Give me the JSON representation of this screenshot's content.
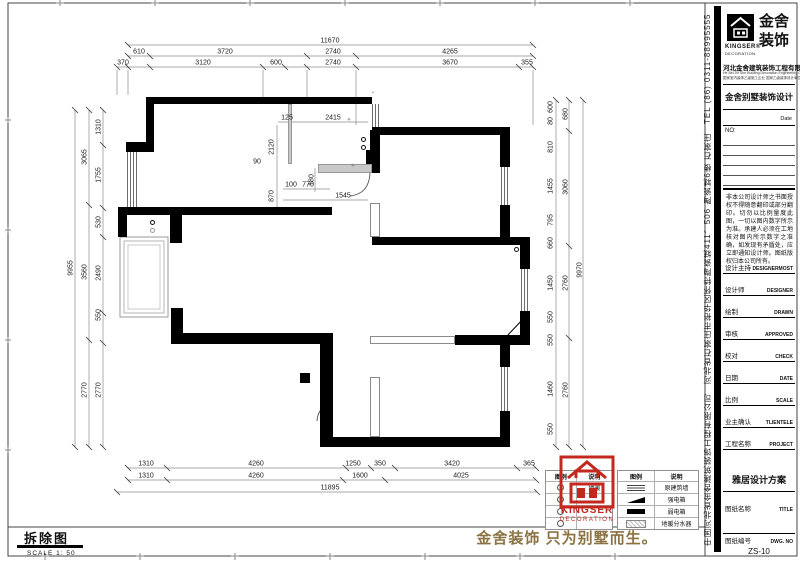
{
  "sheet": {
    "demolition_title": "拆除图",
    "scale_label": "SCALE 1: 50",
    "slogan": "金舍装饰 只为别墅而生。"
  },
  "title_block": {
    "side_text": "中国河北省金舍建筑装饰工程有限公司　河北省石家庄市裕华区怀特陶瓷城411、506 陶瓷城6楼 石家庄　TEL (86) 0311-88995555",
    "logo": {
      "brand_cn_1": "金舍",
      "brand_cn_2": "装饰",
      "brand_en": "KINGSER®",
      "brand_sub": "DECORATION"
    },
    "company": "河北金舍建筑装饰工程有限公司",
    "company_en": "He Bei Jin She Building Decoration Engineering Co.,Ltd",
    "company_note": "国家室内装饰乙级施工企业 国家乙级装饰设计单位",
    "project_type": "金舍别墅装饰设计",
    "date_label": "Date",
    "no_label": "NO:",
    "disclaimer": "非本公司设计师之书面授权不得随意翻印或部分翻印。切勿以比例量度此图，一切以图内数字所示为准。承建人必须在工地核对图内所示数字之准确，如发现有矛盾处，应立即通知设计师。图纸版权归本公司所有。",
    "rows": [
      {
        "cn": "设计主持",
        "en": "DESIGNERMOST"
      },
      {
        "cn": "设计师",
        "en": "DESIGNER"
      },
      {
        "cn": "绘制",
        "en": "DRAWN"
      },
      {
        "cn": "审核",
        "en": "APPROVED"
      },
      {
        "cn": "校对",
        "en": "CHECK"
      },
      {
        "cn": "日期",
        "en": "DATE"
      },
      {
        "cn": "比例",
        "en": "SCALE"
      },
      {
        "cn": "业主确认",
        "en": "TLIENTELE"
      },
      {
        "cn": "工程名称",
        "en": "PROJECT"
      }
    ],
    "project_name": "雅居设计方案",
    "title_row": {
      "cn": "图纸名称",
      "en": "TITLE"
    },
    "dwg_row": {
      "cn": "图纸编号",
      "en": "DWG. NO"
    },
    "dwg_no": "ZS-10"
  },
  "legend_left": {
    "headers": [
      "图例",
      "说明"
    ],
    "rows": [
      {
        "label": "地暖"
      },
      {
        "label": ""
      },
      {
        "label": ""
      },
      {
        "label": ""
      }
    ]
  },
  "legend_right": {
    "headers": [
      "图例",
      "说明"
    ],
    "rows": [
      {
        "label": "原建筑墙"
      },
      {
        "label": "强电箱"
      },
      {
        "label": "弱电箱"
      },
      {
        "label": "地暖分水器"
      }
    ]
  },
  "stamp": {
    "brand": "KINGSER",
    "sub": "DECORATION"
  },
  "colors": {
    "accent_red": "#c3281e",
    "slogan_gold": "#8a7243",
    "wall_black": "#000000"
  },
  "plan": {
    "labels": [
      {
        "t": "11670",
        "x": 330,
        "y": 41
      },
      {
        "t": "610",
        "x": 139,
        "y": 52
      },
      {
        "t": "3720",
        "x": 225,
        "y": 52
      },
      {
        "t": "2740",
        "x": 333,
        "y": 52
      },
      {
        "t": "4265",
        "x": 450,
        "y": 52
      },
      {
        "t": "370",
        "x": 123,
        "y": 63
      },
      {
        "t": "3120",
        "x": 203,
        "y": 63
      },
      {
        "t": "600",
        "x": 276,
        "y": 63
      },
      {
        "t": "2740",
        "x": 333,
        "y": 63
      },
      {
        "t": "3670",
        "x": 450,
        "y": 63
      },
      {
        "t": "355",
        "x": 527,
        "y": 63
      },
      {
        "t": "9955",
        "x": 71,
        "y": 268,
        "v": 1
      },
      {
        "t": "3065",
        "x": 85,
        "y": 157,
        "v": 1
      },
      {
        "t": "3560",
        "x": 85,
        "y": 272,
        "v": 1
      },
      {
        "t": "2770",
        "x": 85,
        "y": 390,
        "v": 1
      },
      {
        "t": "1310",
        "x": 99,
        "y": 127,
        "v": 1
      },
      {
        "t": "1755",
        "x": 99,
        "y": 175,
        "v": 1
      },
      {
        "t": "530",
        "x": 99,
        "y": 222,
        "v": 1
      },
      {
        "t": "2490",
        "x": 99,
        "y": 273,
        "v": 1
      },
      {
        "t": "550",
        "x": 99,
        "y": 315,
        "v": 1
      },
      {
        "t": "2770",
        "x": 99,
        "y": 390,
        "v": 1
      },
      {
        "t": "9970",
        "x": 580,
        "y": 270,
        "v": 1
      },
      {
        "t": "680",
        "x": 566,
        "y": 114,
        "v": 1
      },
      {
        "t": "3060",
        "x": 566,
        "y": 187,
        "v": 1
      },
      {
        "t": "2760",
        "x": 566,
        "y": 283,
        "v": 1
      },
      {
        "t": "2760",
        "x": 566,
        "y": 390,
        "v": 1
      },
      {
        "t": "600",
        "x": 551,
        "y": 107,
        "v": 1
      },
      {
        "t": "80",
        "x": 551,
        "y": 121,
        "v": 1
      },
      {
        "t": "810",
        "x": 551,
        "y": 147,
        "v": 1
      },
      {
        "t": "1455",
        "x": 551,
        "y": 186,
        "v": 1
      },
      {
        "t": "795",
        "x": 551,
        "y": 220,
        "v": 1
      },
      {
        "t": "660",
        "x": 551,
        "y": 243,
        "v": 1
      },
      {
        "t": "1450",
        "x": 551,
        "y": 283,
        "v": 1
      },
      {
        "t": "550",
        "x": 551,
        "y": 317,
        "v": 1
      },
      {
        "t": "550",
        "x": 551,
        "y": 340,
        "v": 1
      },
      {
        "t": "1460",
        "x": 551,
        "y": 389,
        "v": 1
      },
      {
        "t": "550",
        "x": 551,
        "y": 429,
        "v": 1
      },
      {
        "t": "1310",
        "x": 146,
        "y": 464
      },
      {
        "t": "4260",
        "x": 256,
        "y": 464
      },
      {
        "t": "1250",
        "x": 353,
        "y": 464
      },
      {
        "t": "350",
        "x": 380,
        "y": 464
      },
      {
        "t": "3420",
        "x": 452,
        "y": 464
      },
      {
        "t": "365",
        "x": 529,
        "y": 464
      },
      {
        "t": "1310",
        "x": 146,
        "y": 476
      },
      {
        "t": "4260",
        "x": 256,
        "y": 476
      },
      {
        "t": "1600",
        "x": 360,
        "y": 476
      },
      {
        "t": "4025",
        "x": 461,
        "y": 476
      },
      {
        "t": "11895",
        "x": 330,
        "y": 488
      },
      {
        "t": "125",
        "x": 287,
        "y": 118
      },
      {
        "t": "2415",
        "x": 333,
        "y": 118
      },
      {
        "t": "2120",
        "x": 272,
        "y": 147,
        "v": 1
      },
      {
        "t": "870",
        "x": 272,
        "y": 196,
        "v": 1
      },
      {
        "t": "90",
        "x": 257,
        "y": 162
      },
      {
        "t": "180",
        "x": 312,
        "y": 180,
        "v": 1
      },
      {
        "t": "100",
        "x": 291,
        "y": 185
      },
      {
        "t": "770",
        "x": 308,
        "y": 185
      },
      {
        "t": "1545",
        "x": 343,
        "y": 196
      }
    ]
  }
}
